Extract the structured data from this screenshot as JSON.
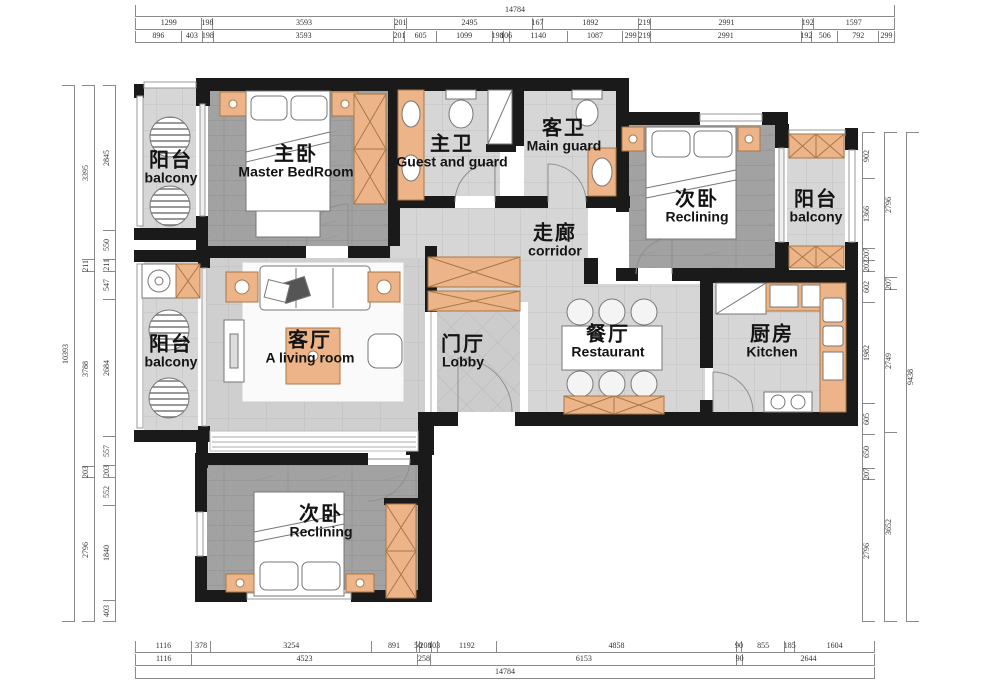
{
  "rooms": {
    "balcony_tl": {
      "zh": "阳台",
      "en": "balcony"
    },
    "master": {
      "zh": "主卧",
      "en": "Master BedRoom"
    },
    "bath_master": {
      "zh": "主卫",
      "en": "Guest and guard"
    },
    "bath_guest": {
      "zh": "客卫",
      "en": "Main guard"
    },
    "bed_tr": {
      "zh": "次卧",
      "en": "Reclining"
    },
    "balcony_r": {
      "zh": "阳台",
      "en": "balcony"
    },
    "corridor": {
      "zh": "走廊",
      "en": "corridor"
    },
    "living": {
      "zh": "客厅",
      "en": "A living room"
    },
    "balcony_l": {
      "zh": "阳台",
      "en": "balcony"
    },
    "lobby": {
      "zh": "门厅",
      "en": "Lobby"
    },
    "dining": {
      "zh": "餐厅",
      "en": "Restaurant"
    },
    "kitchen": {
      "zh": "厨房",
      "en": "Kitchen"
    },
    "bed_b": {
      "zh": "次卧",
      "en": "Reclining"
    }
  },
  "dimensions": {
    "top_total": [
      "14784"
    ],
    "top_row1": [
      "1299",
      "198",
      "3593",
      "201",
      "2495",
      "167",
      "1892",
      "219",
      "2991",
      "192",
      "1597"
    ],
    "top_row2": [
      "896",
      "403",
      "198",
      "3593",
      "201",
      "605",
      "1099",
      "198",
      "106",
      "1140",
      "1087",
      "299",
      "219",
      "2991",
      "192",
      "506",
      "792",
      "299"
    ],
    "bottom_row1": [
      "1116",
      "378",
      "3254",
      "891",
      "50",
      "208",
      "103",
      "1192",
      "4858",
      "90",
      "855",
      "185",
      "1604"
    ],
    "bottom_row2": [
      "1116",
      "4523",
      "258",
      "6153",
      "90",
      "2644"
    ],
    "bottom_total": [
      "14784"
    ],
    "left_outer": [
      "10393"
    ],
    "left_mid": [
      "3395",
      "211",
      "3788",
      "203",
      "2796"
    ],
    "left_inner": [
      "2845",
      "550",
      "211",
      "547",
      "2684",
      "557",
      "203",
      "552",
      "1840",
      "403"
    ],
    "right_inner": [
      "902",
      "1366",
      "207",
      "202",
      "602",
      "1982",
      "605",
      "650",
      "207",
      "2796"
    ],
    "right_mid": [
      "2796",
      "207",
      "2749",
      "3652"
    ],
    "right_outer": [
      "9438"
    ]
  },
  "colors": {
    "wall": "#1a1a1a",
    "accent_orange": "#ecb488",
    "floor_dark": "#a2a2a2",
    "floor_light": "#d6d6d6"
  }
}
